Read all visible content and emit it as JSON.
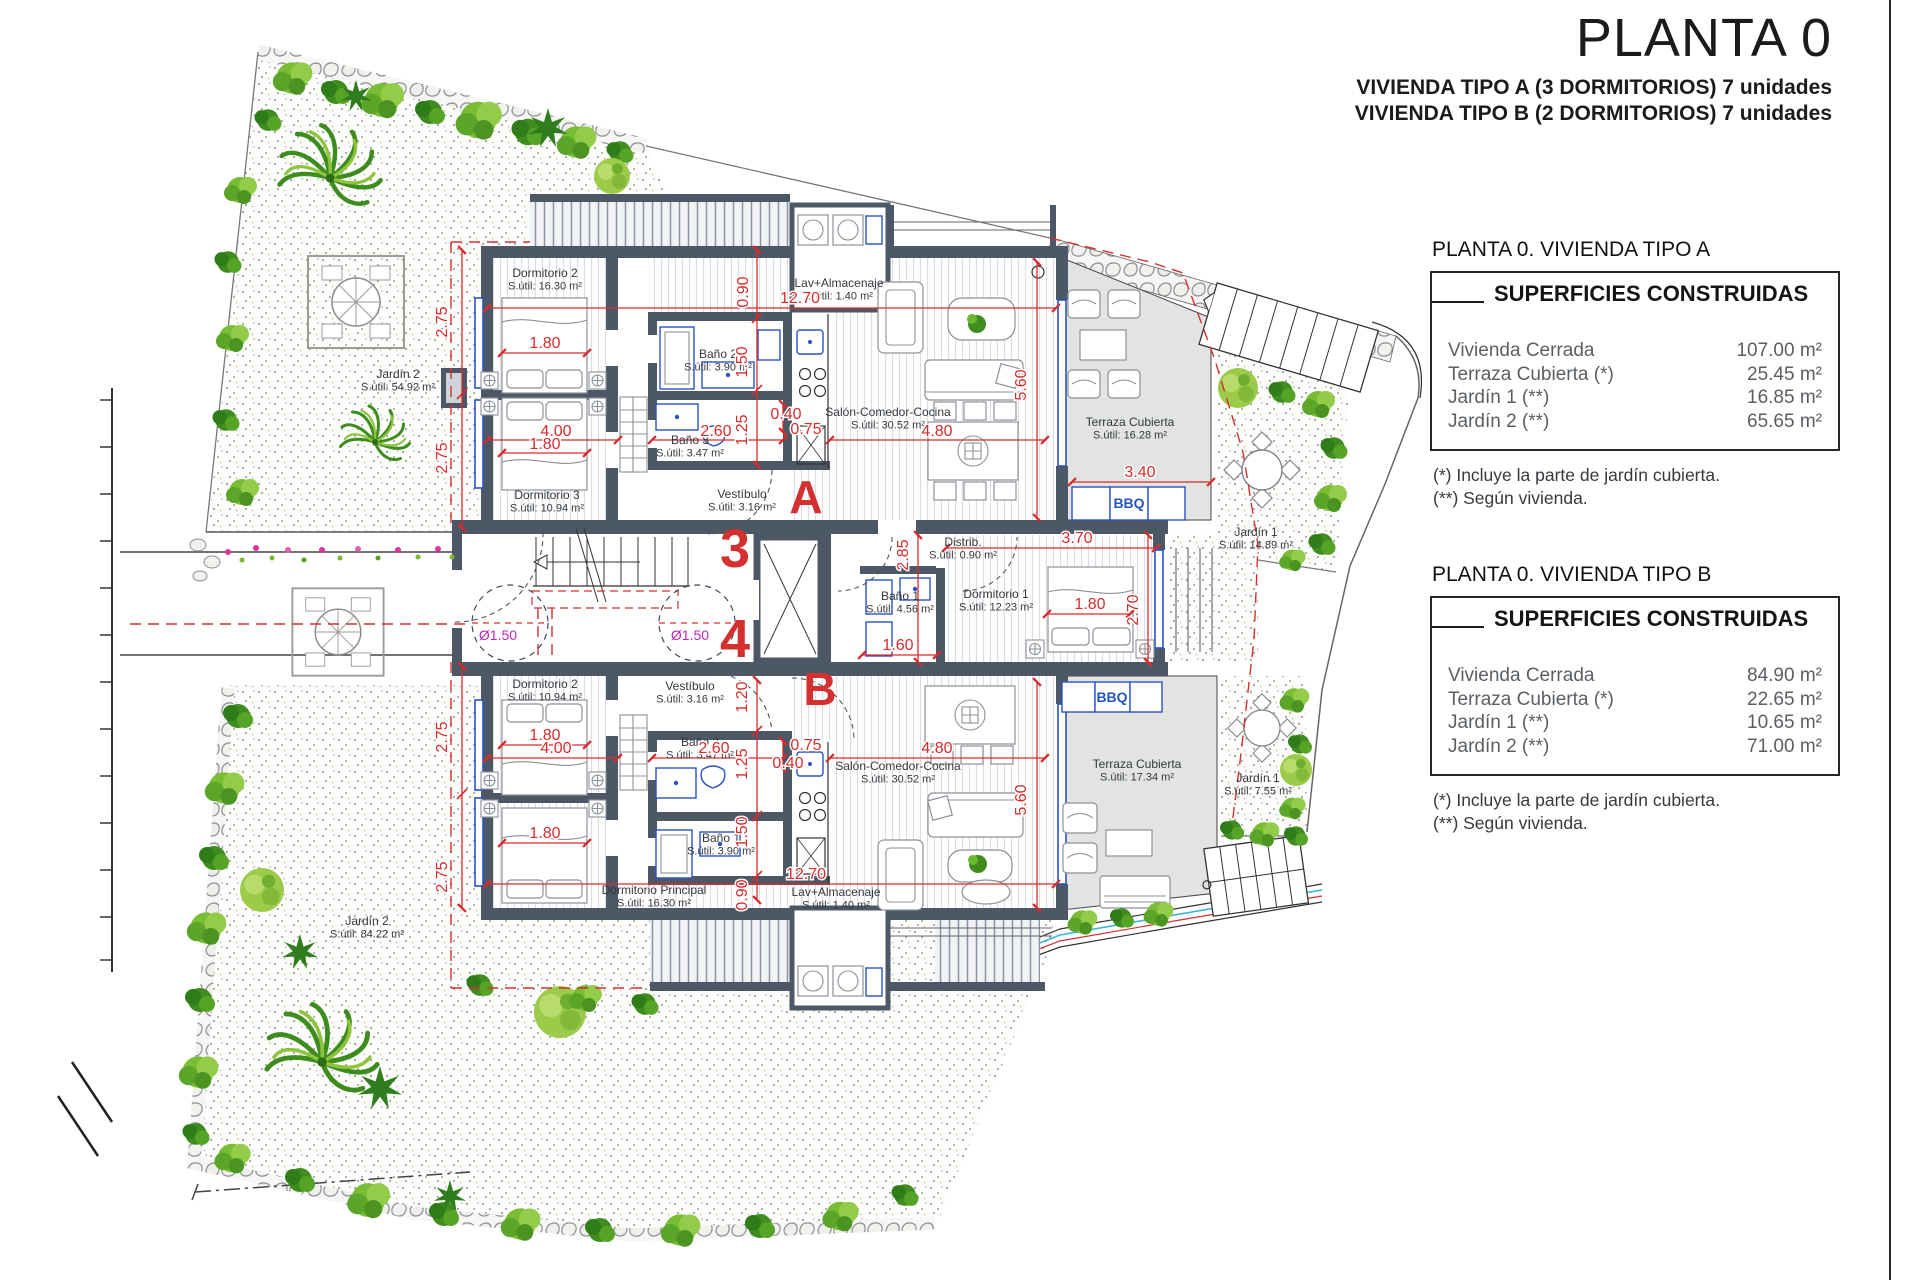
{
  "title_block": {
    "title": "PLANTA 0",
    "subtitle_a": "VIVIENDA TIPO A (3 DORMITORIOS) 7 unidades",
    "subtitle_b": "VIVIENDA TIPO B (2 DORMITORIOS) 7 unidades"
  },
  "panels": [
    {
      "title": "PLANTA 0. VIVIENDA TIPO A",
      "header": "SUPERFICIES CONSTRUIDAS",
      "rows": [
        {
          "label": "Vivienda Cerrada",
          "value": "107.00 m²"
        },
        {
          "label": "Terraza Cubierta  (*)",
          "value": "25.45 m²"
        },
        {
          "label": "Jardín 1 (**)",
          "value": "16.85 m²"
        },
        {
          "label": "Jardín 2 (**)",
          "value": "65.65 m²"
        }
      ],
      "notes": [
        "(*)  Incluye la parte de jardín cubierta.",
        "(**) Según vivienda."
      ]
    },
    {
      "title": "PLANTA 0. VIVIENDA TIPO B",
      "header": "SUPERFICIES CONSTRUIDAS",
      "rows": [
        {
          "label": "Vivienda Cerrada",
          "value": "84.90 m²"
        },
        {
          "label": "Terraza Cubierta (*)",
          "value": "22.65 m²"
        },
        {
          "label": "Jardín 1 (**)",
          "value": "10.65 m²"
        },
        {
          "label": "Jardín 2 (**)",
          "value": "71.00 m²"
        }
      ],
      "notes": [
        "(*) Incluye la parte de jardín cubierta.",
        "(**) Según vivienda."
      ]
    }
  ],
  "plan": {
    "rooms": [
      {
        "name": "Dormitorio 2",
        "area": "S.útil: 16.30 m²",
        "x": 545,
        "y": 277
      },
      {
        "name": "Lav+Almacenaje",
        "area": "S.útil: 1.40 m²",
        "x": 839,
        "y": 287
      },
      {
        "name": "Baño 2",
        "area": "S.útil: 3.90 m²",
        "x": 718,
        "y": 358
      },
      {
        "name": "Baño 3",
        "area": "S.útil: 3.47 m²",
        "x": 690,
        "y": 444
      },
      {
        "name": "Dormitorio 3",
        "area": "S.útil: 10.94 m²",
        "x": 547,
        "y": 499
      },
      {
        "name": "Vestíbulo",
        "area": "S.útil: 3.16 m²",
        "x": 742,
        "y": 498
      },
      {
        "name": "Salón-Comedor-Cocina",
        "area": "S.útil: 30.52 m²",
        "x": 888,
        "y": 416
      },
      {
        "name": "Terraza Cubierta",
        "area": "S.útil: 16.28 m²",
        "x": 1130,
        "y": 426
      },
      {
        "name": "Distrib.",
        "area": "S.útil: 0.90 m²",
        "x": 963,
        "y": 546
      },
      {
        "name": "Baño 1",
        "area": "S.útil: 4.56 m²",
        "x": 900,
        "y": 600
      },
      {
        "name": "Dormitorio 1",
        "area": "S.útil: 12.23 m²",
        "x": 996,
        "y": 598
      },
      {
        "name": "Jardín 1",
        "area": "S.útil: 14.89 m²",
        "x": 1256,
        "y": 536
      },
      {
        "name": "Jardín 2",
        "area": "S.útil: 54.92 m²",
        "x": 398,
        "y": 378
      },
      {
        "name": "Dormitorio 2",
        "area": "S.útil: 10.94 m²",
        "x": 545,
        "y": 688
      },
      {
        "name": "Vestíbulo",
        "area": "S.útil: 3.16 m²",
        "x": 690,
        "y": 690
      },
      {
        "name": "Baño 2",
        "area": "S.útil: 3.47 m²",
        "x": 700,
        "y": 746
      },
      {
        "name": "Baño 1",
        "area": "S.útil: 3.90 m²",
        "x": 721,
        "y": 842
      },
      {
        "name": "Dormitorio Principal",
        "area": "S.útil: 16.30 m²",
        "x": 654,
        "y": 894
      },
      {
        "name": "Lav+Almacenaje",
        "area": "S.útil: 1.40 m²",
        "x": 836,
        "y": 896
      },
      {
        "name": "Salón-Comedor-Cocina",
        "area": "S.útil: 30.52 m²",
        "x": 898,
        "y": 770
      },
      {
        "name": "Terraza Cubierta",
        "area": "S.útil: 17.34 m²",
        "x": 1137,
        "y": 768
      },
      {
        "name": "Jardín 1",
        "area": "S.útil: 7.55 m²",
        "x": 1258,
        "y": 782
      },
      {
        "name": "Jardín 2",
        "area": "S.útil: 84.22 m²",
        "x": 367,
        "y": 925
      }
    ],
    "dims": [
      {
        "t": "12.70",
        "x": 800,
        "y": 303
      },
      {
        "t": "0.90",
        "x": 748,
        "y": 292,
        "r": 1
      },
      {
        "t": "1.80",
        "x": 545,
        "y": 348
      },
      {
        "t": "4.00",
        "x": 556,
        "y": 436
      },
      {
        "t": "1.80",
        "x": 545,
        "y": 449
      },
      {
        "t": "2.60",
        "x": 716,
        "y": 436
      },
      {
        "t": "1.50",
        "x": 747,
        "y": 362,
        "r": 1
      },
      {
        "t": "1.25",
        "x": 747,
        "y": 430,
        "r": 1
      },
      {
        "t": "0.40",
        "x": 786,
        "y": 419
      },
      {
        "t": "0.75",
        "x": 806,
        "y": 434
      },
      {
        "t": "4.80",
        "x": 937,
        "y": 436
      },
      {
        "t": "5.60",
        "x": 1026,
        "y": 385,
        "r": 1
      },
      {
        "t": "3.40",
        "x": 1140,
        "y": 477
      },
      {
        "t": "2.75",
        "x": 447,
        "y": 322,
        "r": 1
      },
      {
        "t": "2.75",
        "x": 447,
        "y": 458,
        "r": 1
      },
      {
        "t": "2.85",
        "x": 908,
        "y": 555,
        "r": 1
      },
      {
        "t": "3.70",
        "x": 1077,
        "y": 543
      },
      {
        "t": "1.80",
        "x": 1090,
        "y": 609
      },
      {
        "t": "2.70",
        "x": 1138,
        "y": 610,
        "r": 1
      },
      {
        "t": "1.60",
        "x": 898,
        "y": 650
      },
      {
        "t": "1.20",
        "x": 747,
        "y": 697,
        "r": 1
      },
      {
        "t": "1.80",
        "x": 545,
        "y": 740
      },
      {
        "t": "4.00",
        "x": 556,
        "y": 753
      },
      {
        "t": "2.60",
        "x": 714,
        "y": 753
      },
      {
        "t": "1.25",
        "x": 747,
        "y": 764,
        "r": 1
      },
      {
        "t": "0.40",
        "x": 788,
        "y": 768
      },
      {
        "t": "0.75",
        "x": 806,
        "y": 750
      },
      {
        "t": "1.50",
        "x": 747,
        "y": 832,
        "r": 1
      },
      {
        "t": "1.80",
        "x": 545,
        "y": 838
      },
      {
        "t": "0.90",
        "x": 747,
        "y": 895,
        "r": 1
      },
      {
        "t": "12.70",
        "x": 806,
        "y": 879
      },
      {
        "t": "4.80",
        "x": 937,
        "y": 753
      },
      {
        "t": "5.60",
        "x": 1026,
        "y": 800,
        "r": 1
      },
      {
        "t": "2.75",
        "x": 447,
        "y": 737,
        "r": 1
      },
      {
        "t": "2.75",
        "x": 447,
        "y": 877,
        "r": 1
      }
    ],
    "letters": [
      {
        "t": "A",
        "x": 806,
        "y": 513,
        "s": 46
      },
      {
        "t": "B",
        "x": 820,
        "y": 705,
        "s": 46
      },
      {
        "t": "3",
        "x": 735,
        "y": 567,
        "s": 54
      },
      {
        "t": "4",
        "x": 735,
        "y": 657,
        "s": 54
      }
    ],
    "turn_circles": {
      "label": "Ø1.50",
      "items": [
        {
          "x": 498,
          "y": 640
        },
        {
          "x": 690,
          "y": 640
        }
      ]
    },
    "bbq": {
      "label": "BBQ",
      "positions": [
        {
          "x": 1129,
          "y": 508
        },
        {
          "x": 1112,
          "y": 702
        }
      ]
    }
  }
}
